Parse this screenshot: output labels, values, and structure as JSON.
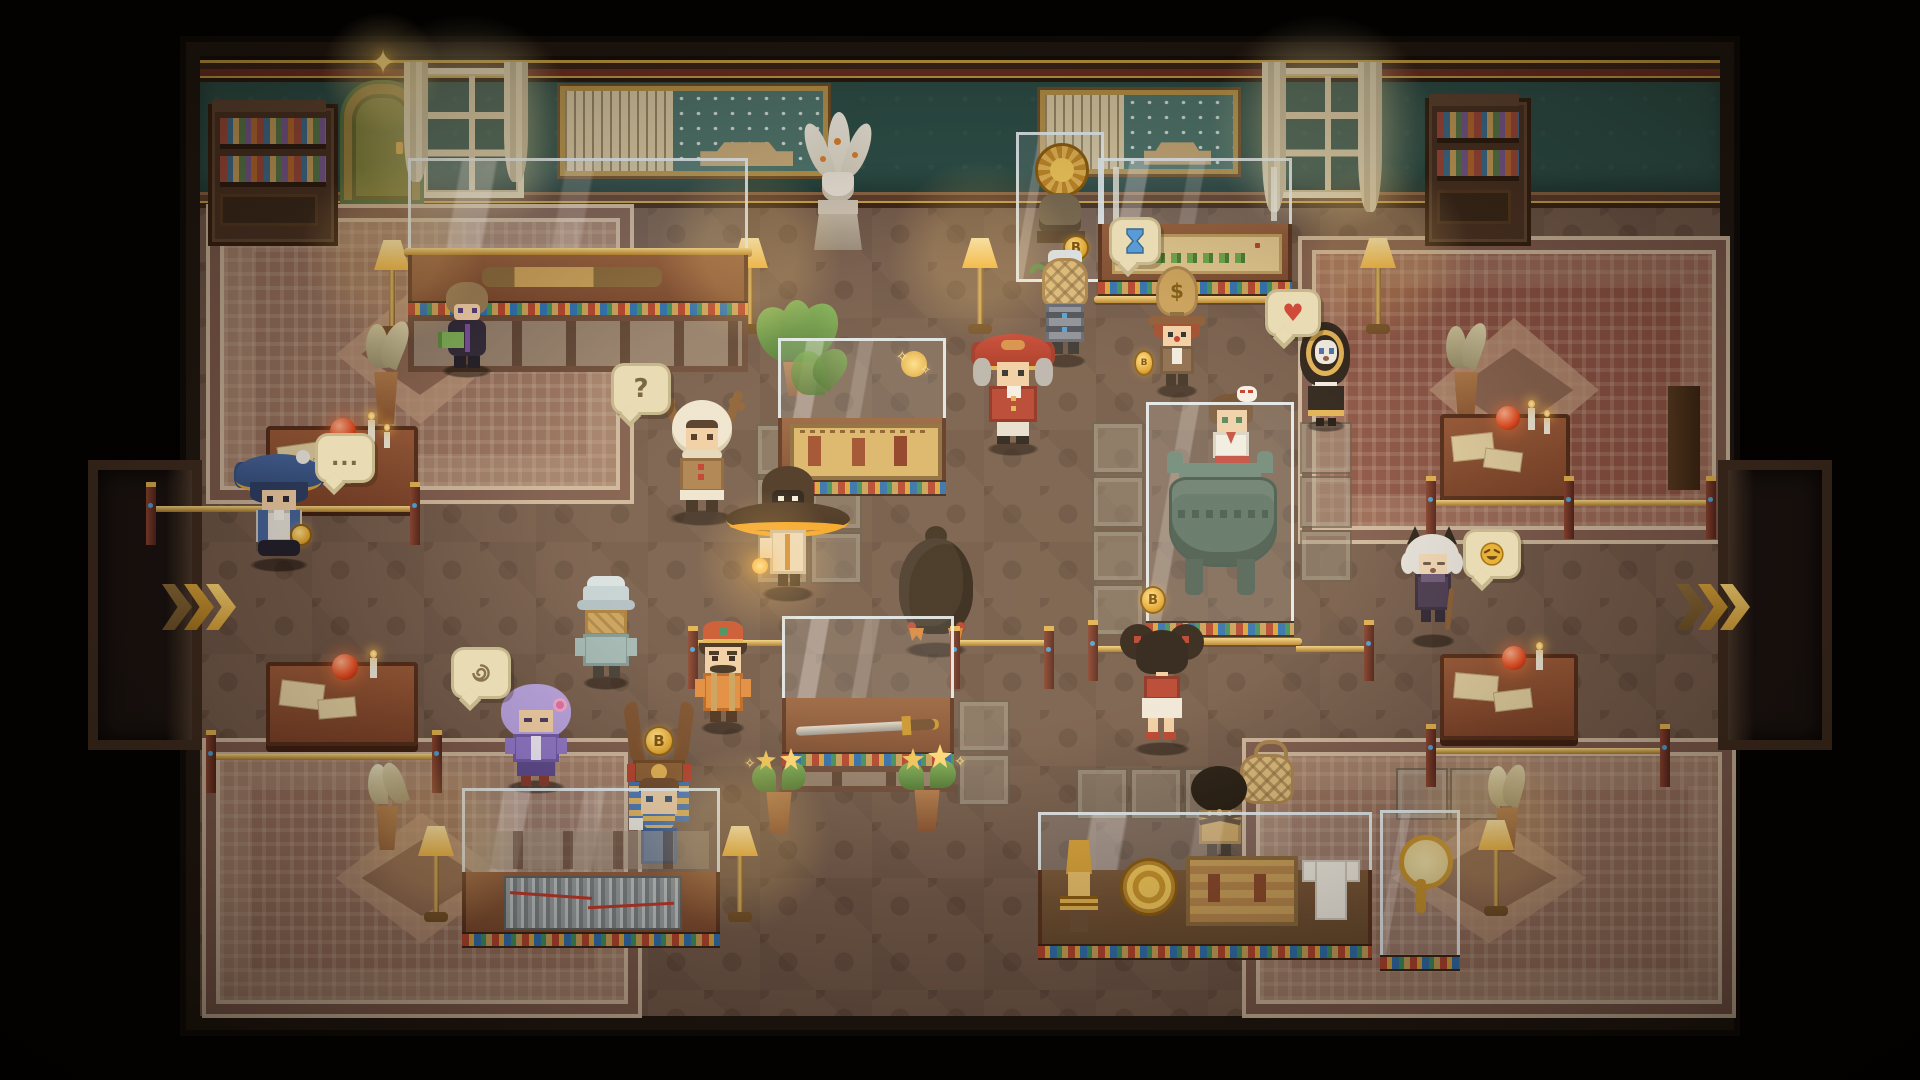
{
  "scene": {
    "name": "Pixel Museum Hall",
    "style": "top-down pixel-art game interior, warm lamp-lit museum full of visitors",
    "palette": {
      "background": "#000000",
      "wall_teal": "#2d4f48",
      "floor_brown": "#745b4b",
      "wood_dark": "#4a3222",
      "gold_accent": "#d4a43c",
      "glass_frame": "#eaf3f7",
      "carpet_rose": "#96705d",
      "carpet_red": "#8a5243",
      "lamp_glow": "#ffd977",
      "bubble_tan": "#e9dcb4"
    }
  },
  "bubbles": {
    "question": "?",
    "ellipsis": "...",
    "heart": "♥",
    "dollar": "$",
    "coin_letter": "B",
    "star": "✦",
    "sparkle": "✧",
    "swirl": "swirl-scribble-icon",
    "hourglass": "hourglass-icon",
    "laugh": "laughing-face-icon"
  },
  "characters": [
    {
      "id": "scholar-green-book",
      "look": "brown hair, dark purple outfit, holds green book",
      "bubble": null
    },
    {
      "id": "deer-hood-kid",
      "look": "white hood with antlers, brown coat, red buttons",
      "bubble": "question"
    },
    {
      "id": "witch-hat-wanderer",
      "look": "huge dark hat with orange glow lining, pale robe, glowing lantern",
      "bubble": null
    },
    {
      "id": "bucket-hat-traveler",
      "look": "pale blue bucket hat, straw basket backpack, teal coat, back view",
      "bubble": null
    },
    {
      "id": "purple-haired-girl",
      "look": "lavender bob with pink flower clip, purple coat",
      "bubble": "swirl"
    },
    {
      "id": "fez-curator",
      "look": "red fez with gold band, mustache, orange suspenders outfit",
      "bubble": null
    },
    {
      "id": "blue-tricorn-captain",
      "look": "big navy tricorn with gold trim, pocket watch",
      "bubble": "ellipsis"
    },
    {
      "id": "pharaoh-crown-girl",
      "look": "tall horned crown with gold coin, striped nemes, blue dress, behind case",
      "bubble": "coin"
    },
    {
      "id": "round-bird",
      "look": "big dark round bird seen from behind, orange feet",
      "bubble": null
    },
    {
      "id": "red-tricorn-noble",
      "look": "red tricorn, grey powdered wig, red coat with gold buttons",
      "bubble": null
    },
    {
      "id": "basket-backpack-visitor",
      "look": "woven basket pack over grey armored frame, back view",
      "bubble": null
    },
    {
      "id": "money-bag-trader",
      "look": "money-bag hat with dollar sign, red-brown hair, brown coat, coin at feet",
      "bubble": "dollar"
    },
    {
      "id": "shrine-maiden",
      "look": "fox mask on head, white kimono, red hakama, behind bronze case",
      "bubble": null
    },
    {
      "id": "hooded-nun",
      "look": "black hood with gold ring trim, white face",
      "bubble": "heart"
    },
    {
      "id": "cat-eared-elder",
      "look": "white fluffy hair, black cat ears, dark coat, cane",
      "bubble": "laugh"
    },
    {
      "id": "bun-haired-girl",
      "look": "two big hair buns, red top, white skirt, back view",
      "bubble": "coin"
    },
    {
      "id": "curly-haired-visitor",
      "look": "dark afro, gold outfit with straps, back view, basket beside",
      "bubble": null
    }
  ],
  "exhibits": [
    {
      "id": "bronze-telescope",
      "case": "long-case-top-left"
    },
    {
      "id": "landscape-scroll-painting",
      "case": "long-case-top-right"
    },
    {
      "id": "gold-sun-disc",
      "case": "small-wall-case"
    },
    {
      "id": "bronze-figurine",
      "case": "small-wall-case"
    },
    {
      "id": "jade-snake",
      "case": "small-wall-case"
    },
    {
      "id": "egyptian-papyrus-painting",
      "case": "center-case"
    },
    {
      "id": "bronze-sword",
      "case": "center-low-case"
    },
    {
      "id": "bamboo-slip-scroll",
      "case": "bottom-left-case"
    },
    {
      "id": "bronze-ding-vessel",
      "case": "tall-center-vitrine"
    },
    {
      "id": "nefertiti-bust",
      "case": "bottom-right-case"
    },
    {
      "id": "gold-plate",
      "case": "bottom-right-case"
    },
    {
      "id": "woven-tapestry",
      "case": "bottom-right-case"
    },
    {
      "id": "linen-garment",
      "case": "bottom-right-case"
    },
    {
      "id": "gold-hand-mirror",
      "case": "bottom-right-small-case"
    },
    {
      "id": "white-plume-vase-statue",
      "case": "wall-pedestal"
    },
    {
      "id": "framed-calligraphy-and-painting-left",
      "case": "wall"
    },
    {
      "id": "framed-calligraphy-and-painting-right",
      "case": "wall"
    }
  ],
  "furniture": {
    "bookshelves": 2,
    "windows": 3,
    "green-door": 1,
    "star-lamp": 1,
    "floor-lamps": 7,
    "study-tables": 4,
    "potted-plants": 6,
    "flower-pots": 2,
    "carpets": 4,
    "gold-barriers": "multiple",
    "exit-chevrons": [
      "left-alcove",
      "right-alcove"
    ]
  }
}
